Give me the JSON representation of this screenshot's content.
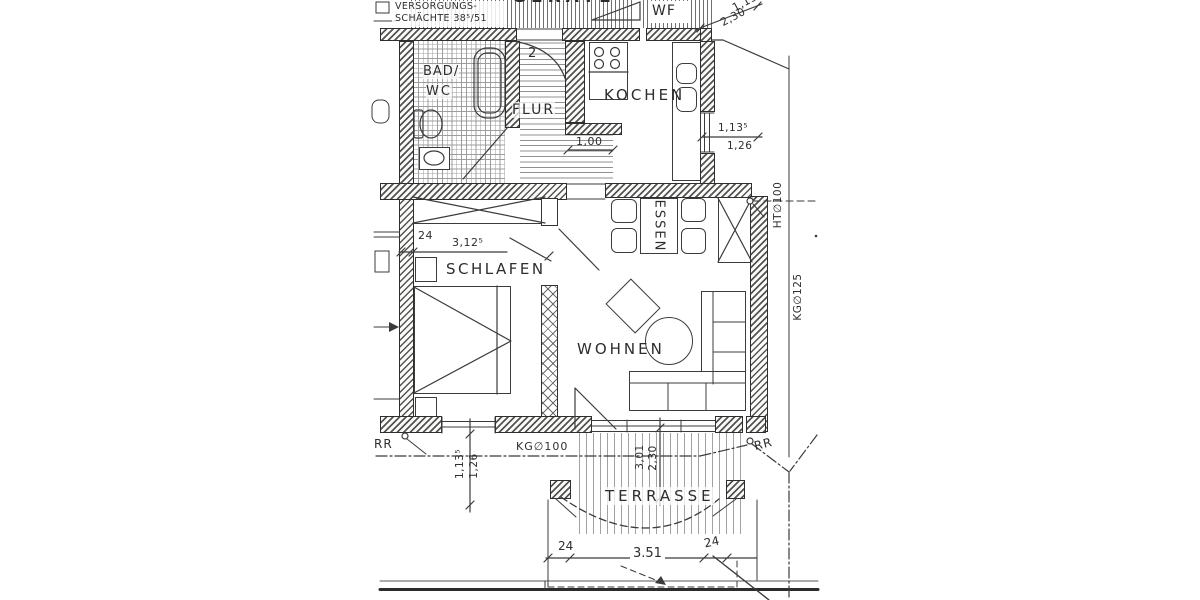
{
  "plan": {
    "rooms": {
      "wf": "WF",
      "bad_line1": "BAD/",
      "bad_line2": "WC",
      "flur": "FLUR",
      "kochen": "KOCHEN",
      "schlafen": "SCHLAFEN",
      "essen": "ESSEN",
      "wohnen": "WOHNEN",
      "terrasse": "TERRASSE"
    },
    "annotations": {
      "shaft_line1": "VERSORGUNGS-",
      "shaft_line2": "SCHÄCHTE 38⁵/51",
      "top_fragment": "GERÄTE",
      "door_number": "2"
    },
    "dimensions": {
      "flur_opening": "1,00",
      "schlafen_offset": "24",
      "schlafen_width": "3,12⁵",
      "kochen_window_raw": "1,13⁵",
      "kochen_window_fin": "1,26",
      "top_right_raw": "1,13⁵",
      "top_right_fin": "2,30",
      "schlafen_window_raw": "1,13⁵",
      "schlafen_window_fin": "1,26",
      "terrace_door_raw": "3,01",
      "terrace_door_fin": "2,30",
      "terrace_post_left": "24",
      "terrace_width": "3.51",
      "terrace_post_right": "24"
    },
    "pipes": {
      "kg100": "KG∅100",
      "kg125": "KG∅125",
      "ht100": "HT∅100",
      "rr_left": "RR",
      "rr_right": "RR"
    },
    "colors": {
      "ink": "#3a3a3a",
      "paper": "#ffffff"
    }
  }
}
